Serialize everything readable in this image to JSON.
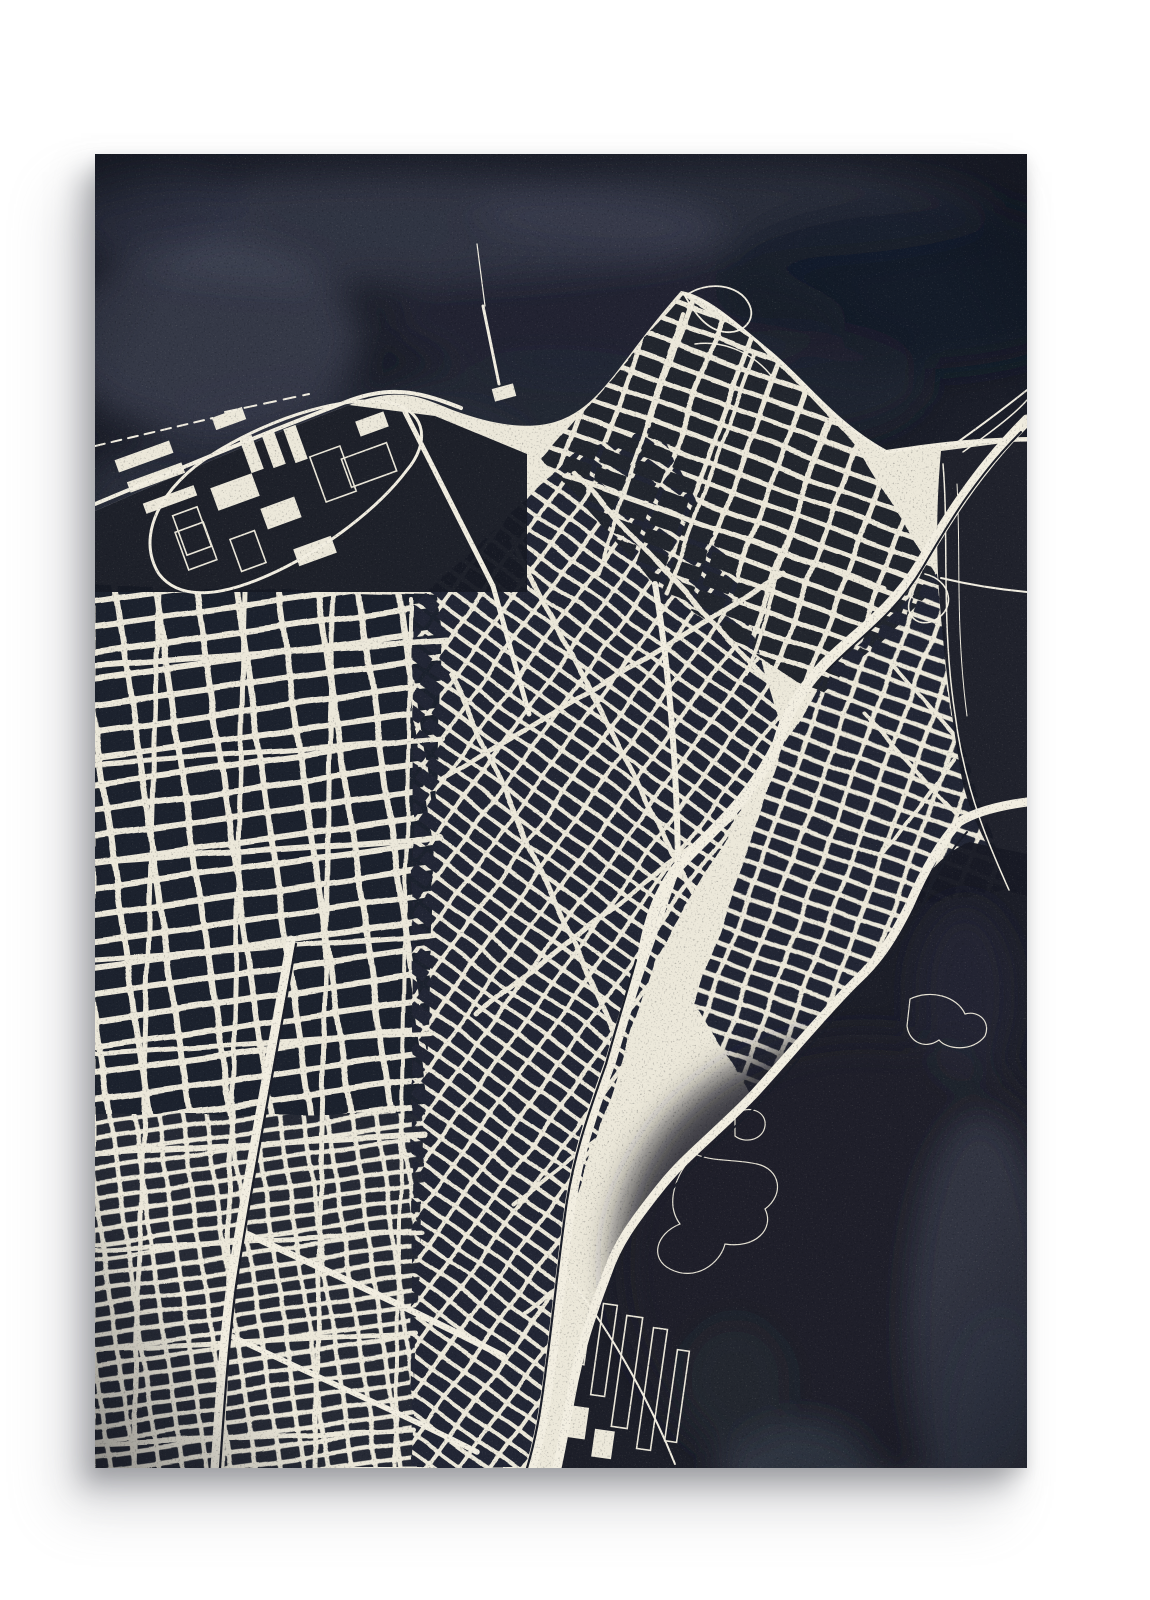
{
  "artwork": {
    "alt": "Blueprint-style aerial city street map art print, cream streets on dark navy watercolor, hanging on a white wall",
    "visible_text": "",
    "palette": {
      "page_bg": "#ffffff",
      "poster_navy": "#1b1e29",
      "water_navy": "#171a24",
      "bay_navy": "#181b25",
      "street_cream": "#ece8da",
      "street_bright": "#f2eee1",
      "hairline": "#e6e2d4",
      "wash_light": "#474c5d",
      "wash_soft": "#575b6a",
      "vignette": "#0a0c14"
    }
  },
  "map_art": {
    "viewbox": "0 0 932 1314",
    "land_path": "M0 357 C71 326 161 286 254 251 C311 229 331 247 366 259 C401 271 431 275 456 269 C506 256 521 211 586 137 C612 141 641 168 676 197 C711 226 737 268 791 296 C826 291 868 284 932 283 L932 1314 L0 1314 Z",
    "lake_path": "M0 0 H932 V283 C868 284 826 291 791 296 C737 268 711 226 676 197 C641 168 612 141 586 137 C521 211 506 256 456 269 C431 275 401 271 366 259 C331 247 311 229 254 251 C161 286 71 326 0 357 Z",
    "harbor_path": "M0 357 C71 326 161 286 254 251 L340 262 L432 300 L432 438 L0 438 Z",
    "inlet_path": "M846 297 L932 286 L932 742 L916 738 C898 700 874 664 866 620 C856 560 846 480 843 420 C841 372 843 330 846 297 Z",
    "bay_path": "M932 700 L874 688 C846 700 826 726 812 752 C794 786 780 806 758 826 C726 858 690 902 657 938 C621 976 588 1000 563 1032 C536 1066 520 1088 510 1118 C494 1160 482 1196 474 1240 C468 1272 464 1294 460 1314 L932 1314 Z",
    "grid_zones": [
      {
        "name": "street-grid-left-upper",
        "poly": "M0 430 L348 442 L330 960 L0 960 Z",
        "angle": -8,
        "pitch": [
          40,
          26
        ],
        "street": 6,
        "block": "#1f222d"
      },
      {
        "name": "street-grid-left-lower",
        "poly": "M0 960 L330 960 L316 1314 L0 1314 Z",
        "angle": -8,
        "pitch": [
          24,
          15
        ],
        "street": 4.5,
        "block": "#262a35"
      },
      {
        "name": "street-grid-center",
        "poly": "M318 452 L480 300 L560 272 L640 420 L690 585 L560 805 L480 1050 L446 1260 L436 1314 L316 1314 Z",
        "angle": 36,
        "pitch": [
          26,
          16
        ],
        "street": 4,
        "block": "#242734"
      },
      {
        "name": "street-grid-northeast",
        "poly": "M446 304 L588 142 L660 186 L764 296 L846 430 L724 544 L560 430 Z",
        "angle": 20,
        "pitch": [
          34,
          20
        ],
        "street": 5,
        "block": "#22252f"
      },
      {
        "name": "street-grid-east",
        "poly": "M736 515 L842 420 L856 560 L914 734 L820 752 L756 828 L654 940 L600 850 L688 592 Z",
        "angle": 20,
        "pitch": [
          28,
          17
        ],
        "street": 4.5,
        "block": "#242734"
      }
    ],
    "arterials": [
      {
        "d": "M0 512 L352 486",
        "w": 6
      },
      {
        "d": "M0 610 L348 584",
        "w": 5
      },
      {
        "d": "M0 708 L344 684",
        "w": 6
      },
      {
        "d": "M0 806 L340 782",
        "w": 5
      },
      {
        "d": "M0 900 L336 878",
        "w": 5
      },
      {
        "d": "M0 1000 L330 980",
        "w": 6
      },
      {
        "d": "M0 1096 L326 1078",
        "w": 5
      },
      {
        "d": "M0 1196 L322 1180",
        "w": 5
      },
      {
        "d": "M0 1290 L318 1276",
        "w": 5
      },
      {
        "d": "M64 434 L38 1314",
        "w": 5
      },
      {
        "d": "M150 438 L128 1314",
        "w": 5
      },
      {
        "d": "M238 440 L220 1314",
        "w": 5
      },
      {
        "d": "M316 446 L300 1314",
        "w": 4
      },
      {
        "d": "M418 388 L610 760",
        "w": 5
      },
      {
        "d": "M356 520 L520 880",
        "w": 5
      },
      {
        "d": "M480 320 L700 556",
        "w": 5
      },
      {
        "d": "M346 626 L690 420",
        "w": 5
      },
      {
        "d": "M380 860 L640 660",
        "w": 5
      },
      {
        "d": "M420 1050 L560 940",
        "w": 4
      },
      {
        "d": "M430 1160 L600 1020",
        "w": 4
      },
      {
        "d": "M470 322 L790 434",
        "w": 5
      },
      {
        "d": "M588 160 L502 420",
        "w": 4
      },
      {
        "d": "M660 200 L572 440",
        "w": 4
      },
      {
        "d": "M730 270 L652 520",
        "w": 4
      },
      {
        "d": "M770 560 L862 662",
        "w": 4
      },
      {
        "d": "M796 508 L876 600",
        "w": 4
      },
      {
        "d": "M788 702 L858 606",
        "w": 4
      }
    ],
    "freeways": [
      {
        "name": "freeway-diagonal",
        "d": "M932 266 C880 318 848 372 826 409 C794 462 754 483 726 514 C702 540 690 564 683 589 C652 652 611 681 583 713 C562 740 553 771 548 801 C536 841 526 871 516 906 C496 961 483 1001 476 1046 C468 1098 457 1210 448 1262 C444 1284 440 1300 436 1314",
        "w": 11
      },
      {
        "name": "freeway-bayshore",
        "d": "M932 648 C902 652 880 658 864 668 C842 692 826 724 814 752 C796 788 782 808 760 828 C728 860 692 904 659 940 C623 978 590 1002 565 1034 C538 1068 522 1090 512 1120 C496 1162 484 1198 476 1242 C470 1274 466 1296 462 1314",
        "w": 9
      },
      {
        "name": "rail-corridor-west",
        "d": "M196 786 C180 880 152 1024 136 1130 C128 1192 124 1254 120 1314",
        "w": 9
      }
    ],
    "dark_lines": [
      {
        "d": "M926 278 C878 326 850 376 828 413 C798 464 760 486 732 517",
        "w": 2
      },
      {
        "d": "M541 806 C530 845 521 874 511 910 C492 963 479 1003 472 1047 C464 1099 453 1211 444 1263 C440 1285 436 1301 432 1314",
        "w": 2.2
      },
      {
        "d": "M872 678 C852 700 836 730 824 758 C806 792 792 812 770 832 C738 864 702 908 669 944 C633 982 600 1006 575 1038",
        "w": 2
      },
      {
        "d": "M201 790 C185 882 157 1026 141 1132 C133 1194 129 1256 125 1314",
        "w": 2.2
      }
    ],
    "thin_roads": [
      {
        "d": "M0 350 C72 320 162 282 256 246 C300 230 330 240 366 254",
        "w": 4
      },
      {
        "d": "M588 140 C615 145 643 172 677 200 C711 228 739 269 792 298 C830 292 870 287 932 286",
        "w": 3
      },
      {
        "d": "M860 290 C888 270 912 252 932 236",
        "w": 2
      },
      {
        "d": "M868 298 C896 278 920 260 932 246",
        "w": 1.5
      },
      {
        "d": "M848 310 C854 380 846 470 860 560 C870 640 898 700 914 736",
        "w": 1.5
      },
      {
        "d": "M862 330 C866 400 860 470 872 562",
        "w": 1
      },
      {
        "d": "M846 424 C880 432 910 436 932 438",
        "w": 2
      },
      {
        "d": "M590 142 C612 126 644 130 654 150 C662 166 648 180 630 178 C612 176 600 160 590 142",
        "w": 1.8
      },
      {
        "d": "M600 190 C630 186 660 200 678 224",
        "w": 1.5
      },
      {
        "d": "M830 420 C856 426 862 454 840 466 C820 476 806 456 818 440",
        "w": 1.6
      },
      {
        "d": "M388 152 L404 230",
        "w": 3
      },
      {
        "d": "M382 90 L390 152",
        "w": 1.2
      },
      {
        "d": "M0 292 L118 264",
        "w": 2,
        "dash": "10 7"
      },
      {
        "d": "M130 258 L214 240",
        "w": 2,
        "dash": "12 8"
      },
      {
        "d": "M64 420 C40 382 66 332 118 300 C178 262 258 238 300 250 C332 260 334 290 312 316 C282 356 222 402 162 426 C122 442 84 446 64 420",
        "w": 3
      },
      {
        "d": "M310 258 L398 432",
        "w": 5
      },
      {
        "d": "M398 432 L434 560",
        "w": 5
      },
      {
        "d": "M560 430 C575 520 582 620 583 713",
        "w": 6
      },
      {
        "d": "M583 713 L504 940",
        "w": 5
      },
      {
        "d": "M152 1080 C222 1112 318 1156 408 1202",
        "w": 6.5
      },
      {
        "d": "M132 1180 C210 1218 300 1256 382 1298",
        "w": 5.5
      },
      {
        "d": "M470 1120 C520 1180 560 1260 580 1310",
        "w": 2
      }
    ],
    "harbor_piers": [
      {
        "x": 20,
        "y": 296,
        "w": 58,
        "h": 13,
        "a": -20,
        "mode": "fill"
      },
      {
        "x": 32,
        "y": 318,
        "w": 58,
        "h": 11,
        "a": -20,
        "mode": "fill"
      },
      {
        "x": 48,
        "y": 340,
        "w": 54,
        "h": 11,
        "a": -20,
        "mode": "fill"
      },
      {
        "x": 150,
        "y": 282,
        "w": 13,
        "h": 36,
        "a": -20,
        "mode": "fill"
      },
      {
        "x": 172,
        "y": 277,
        "w": 13,
        "h": 36,
        "a": -20,
        "mode": "fill"
      },
      {
        "x": 194,
        "y": 272,
        "w": 13,
        "h": 36,
        "a": -20,
        "mode": "fill"
      },
      {
        "x": 250,
        "y": 296,
        "w": 48,
        "h": 30,
        "a": -20,
        "mode": "line"
      },
      {
        "x": 118,
        "y": 258,
        "w": 32,
        "h": 13,
        "a": -20,
        "mode": "fill"
      },
      {
        "x": 86,
        "y": 372,
        "w": 30,
        "h": 40,
        "a": -20,
        "mode": "line"
      },
      {
        "x": 140,
        "y": 380,
        "w": 26,
        "h": 34,
        "a": -20,
        "mode": "line"
      }
    ],
    "airport_aprons": [
      {
        "x": 118,
        "y": 326,
        "w": 44,
        "h": 24,
        "a": -20,
        "mode": "fill"
      },
      {
        "x": 168,
        "y": 348,
        "w": 36,
        "h": 22,
        "a": -20,
        "mode": "fill"
      },
      {
        "x": 222,
        "y": 296,
        "w": 32,
        "h": 48,
        "a": -20,
        "mode": "line"
      },
      {
        "x": 84,
        "y": 356,
        "w": 26,
        "h": 42,
        "a": -20,
        "mode": "line"
      },
      {
        "x": 262,
        "y": 262,
        "w": 30,
        "h": 16,
        "a": -20,
        "mode": "fill"
      },
      {
        "x": 200,
        "y": 388,
        "w": 40,
        "h": 18,
        "a": -20,
        "mode": "fill"
      },
      {
        "x": 398,
        "y": 232,
        "w": 22,
        "h": 13,
        "a": -15,
        "mode": "fill"
      }
    ],
    "dock_piers": [
      {
        "x": 478,
        "y": 1138,
        "w": 16,
        "h": 72,
        "a": 8,
        "mode": "line"
      },
      {
        "x": 502,
        "y": 1150,
        "w": 14,
        "h": 92,
        "a": 8,
        "mode": "line"
      },
      {
        "x": 524,
        "y": 1162,
        "w": 16,
        "h": 112,
        "a": 8,
        "mode": "line"
      },
      {
        "x": 550,
        "y": 1174,
        "w": 14,
        "h": 122,
        "a": 8,
        "mode": "line"
      },
      {
        "x": 576,
        "y": 1196,
        "w": 12,
        "h": 92,
        "a": 8,
        "mode": "line"
      },
      {
        "x": 468,
        "y": 1252,
        "w": 24,
        "h": 32,
        "a": 8,
        "mode": "fill"
      },
      {
        "x": 498,
        "y": 1276,
        "w": 20,
        "h": 28,
        "a": 8,
        "mode": "fill"
      }
    ],
    "island_outlines": [
      "M600 1000 C580 1020 570 1050 585 1070 C560 1080 555 1105 575 1115 C600 1128 625 1110 630 1090 C660 1095 680 1075 670 1055 C690 1040 685 1015 662 1010 C640 1005 618 1008 600 1000 Z",
      "M815 845 C835 835 862 842 870 860 C884 856 896 868 890 882 C878 898 852 896 844 886 C830 896 814 888 812 872 Z",
      "M640 960 C655 950 672 958 670 972 C668 986 650 990 640 982 Z"
    ],
    "washes": [
      {
        "layer": "lake",
        "c": [
          300,
          75
        ],
        "r": [
          330,
          55
        ],
        "fill": "#474c5d",
        "op": 0.5
      },
      {
        "layer": "lake",
        "c": [
          640,
          60
        ],
        "r": [
          260,
          45
        ],
        "fill": "#3f4454",
        "op": 0.4
      },
      {
        "layer": "lake",
        "c": [
          115,
          185
        ],
        "r": [
          150,
          95
        ],
        "fill": "#4e5366",
        "op": 0.5
      },
      {
        "layer": "lake",
        "c": [
          60,
          55
        ],
        "r": [
          95,
          45
        ],
        "fill": "#2e3346",
        "op": 0.55
      },
      {
        "layer": "lake",
        "c": [
          520,
          165
        ],
        "r": [
          230,
          60
        ],
        "fill": "#262b3b",
        "op": 0.55
      },
      {
        "layer": "lake",
        "c": [
          820,
          130
        ],
        "r": [
          200,
          85
        ],
        "fill": "#161926",
        "op": 0.7
      },
      {
        "layer": "lake",
        "c": [
          250,
          320
        ],
        "r": [
          210,
          80
        ],
        "fill": "#3a3f50",
        "op": 0.4
      },
      {
        "layer": "lake",
        "c": [
          450,
          250
        ],
        "r": [
          160,
          45
        ],
        "fill": "#2c3142",
        "op": 0.45
      },
      {
        "layer": "lake",
        "c": [
          700,
          230
        ],
        "r": [
          130,
          55
        ],
        "fill": "#232836",
        "op": 0.5
      },
      {
        "layer": "lake",
        "c": [
          30,
          420
        ],
        "r": [
          60,
          120
        ],
        "fill": "#3f4455",
        "op": 0.4
      },
      {
        "layer": "bay",
        "c": [
          770,
          1110
        ],
        "r": [
          250,
          230
        ],
        "fill": "#1d212c",
        "op": 0.85
      },
      {
        "layer": "bay",
        "c": [
          885,
          1170
        ],
        "r": [
          70,
          210
        ],
        "fill": "#4b505f",
        "op": 0.45
      },
      {
        "layer": "bay",
        "c": [
          790,
          1390
        ],
        "r": [
          110,
          65
        ],
        "fill": "#575b6a",
        "op": 0.5
      },
      {
        "layer": "bay",
        "c": [
          700,
          1315
        ],
        "r": [
          75,
          48
        ],
        "fill": "#4a4f5e",
        "op": 0.45
      },
      {
        "layer": "bay",
        "c": [
          640,
          1230
        ],
        "r": [
          55,
          65
        ],
        "fill": "#262a37",
        "op": 0.55
      },
      {
        "layer": "bay",
        "c": [
          905,
          1290
        ],
        "r": [
          55,
          130
        ],
        "fill": "#3c4150",
        "op": 0.5
      },
      {
        "layer": "bay",
        "c": [
          870,
          840
        ],
        "r": [
          50,
          90
        ],
        "fill": "#2a2e3d",
        "op": 0.5
      }
    ]
  }
}
